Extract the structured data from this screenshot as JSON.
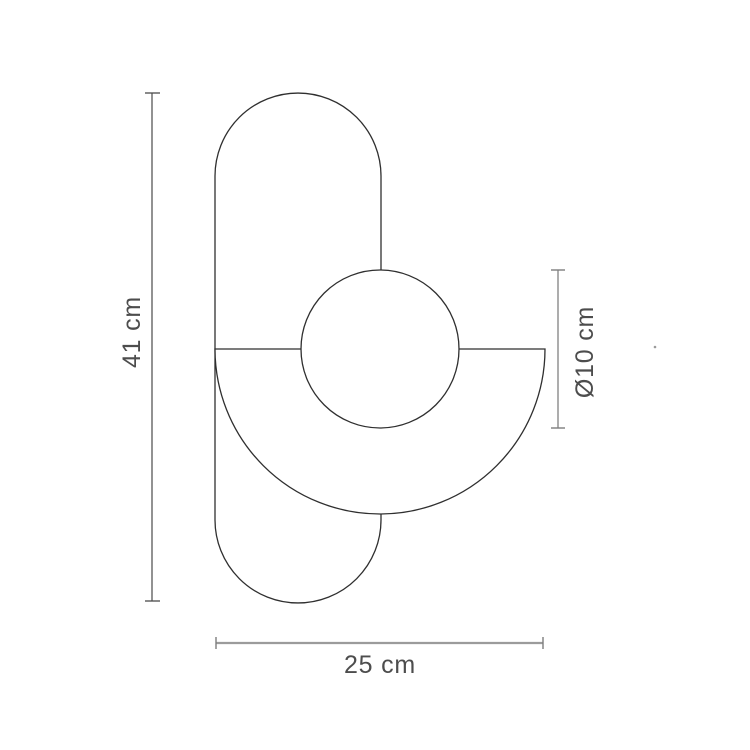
{
  "drawing": {
    "type": "product-dimension-diagram",
    "dimensions": {
      "height": {
        "label": "41 cm",
        "orientation": "vertical-left"
      },
      "diameter": {
        "label": "Ø10 cm",
        "orientation": "vertical-right"
      },
      "width": {
        "label": "25 cm",
        "orientation": "horizontal-bottom"
      }
    },
    "shapes": [
      {
        "name": "capsule-body",
        "kind": "stadium-outline"
      },
      {
        "name": "half-disc-shade",
        "kind": "semicircle-outline"
      },
      {
        "name": "sphere",
        "kind": "circle-outline"
      }
    ],
    "colors": {
      "background": "#ffffff",
      "shape_outline": "#2f2f2f",
      "dimension_line_dark": "#4a4a4a",
      "dimension_line_gray": "#8a8a8a",
      "dimension_line_light": "#9b9b9b",
      "label_text": "#4d4d4d"
    }
  }
}
